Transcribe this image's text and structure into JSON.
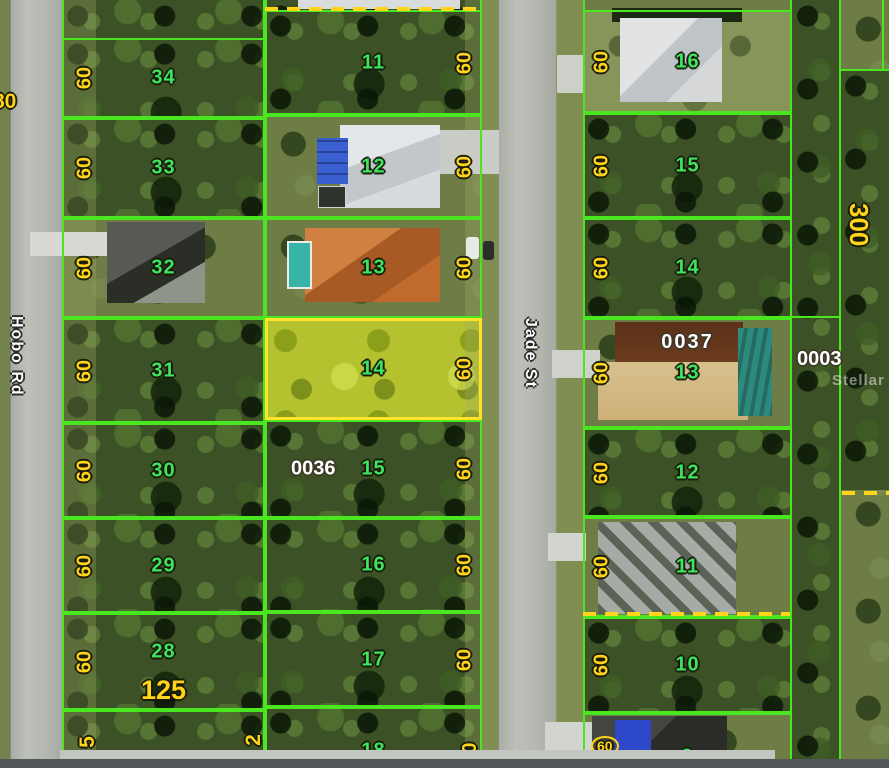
{
  "streets": [
    {
      "name": "Hobo Rd"
    },
    {
      "name": "Jade St"
    }
  ],
  "watermark": "Stellar",
  "edge_dims": {
    "west_partial": "80",
    "bottom_left_partial": "5",
    "bottom_center_partial": "2"
  },
  "east_area": {
    "parcel_id": "0003",
    "depth_dim": "300"
  },
  "left_column": {
    "frontage_dim": "125",
    "lots": [
      {
        "num": "34",
        "dim": "60"
      },
      {
        "num": "33",
        "dim": "60"
      },
      {
        "num": "32",
        "dim": "60"
      },
      {
        "num": "31",
        "dim": "60"
      },
      {
        "num": "30",
        "dim": "60"
      },
      {
        "num": "29",
        "dim": "60"
      },
      {
        "num": "28",
        "dim": "60"
      }
    ]
  },
  "middle_column": {
    "lots": [
      {
        "num": "11",
        "dim": "60"
      },
      {
        "num": "12",
        "dim": "60"
      },
      {
        "num": "13",
        "dim": "60"
      },
      {
        "num": "14",
        "dim": "60"
      },
      {
        "num": "15",
        "dim": "60",
        "parcel_id": "0036"
      },
      {
        "num": "16",
        "dim": "60"
      },
      {
        "num": "17",
        "dim": "60"
      },
      {
        "num": "18",
        "dim": "0"
      }
    ]
  },
  "right_column": {
    "lots": [
      {
        "num": "16",
        "dim": "60"
      },
      {
        "num": "15",
        "dim": "60"
      },
      {
        "num": "14",
        "dim": "60"
      },
      {
        "num": "13",
        "dim": "60",
        "parcel_id": "0037"
      },
      {
        "num": "12",
        "dim": "60"
      },
      {
        "num": "11",
        "dim": "60"
      },
      {
        "num": "10",
        "dim": "60"
      },
      {
        "num": "9",
        "dim": "60"
      }
    ]
  },
  "colors": {
    "lot_line_green": "#4ae61f",
    "highlight_yellow": "#ffe32a",
    "dim_text_yellow": "#ffd41a",
    "lot_number_green": "#3ee35f",
    "parcel_id_white": "#ffffff"
  }
}
